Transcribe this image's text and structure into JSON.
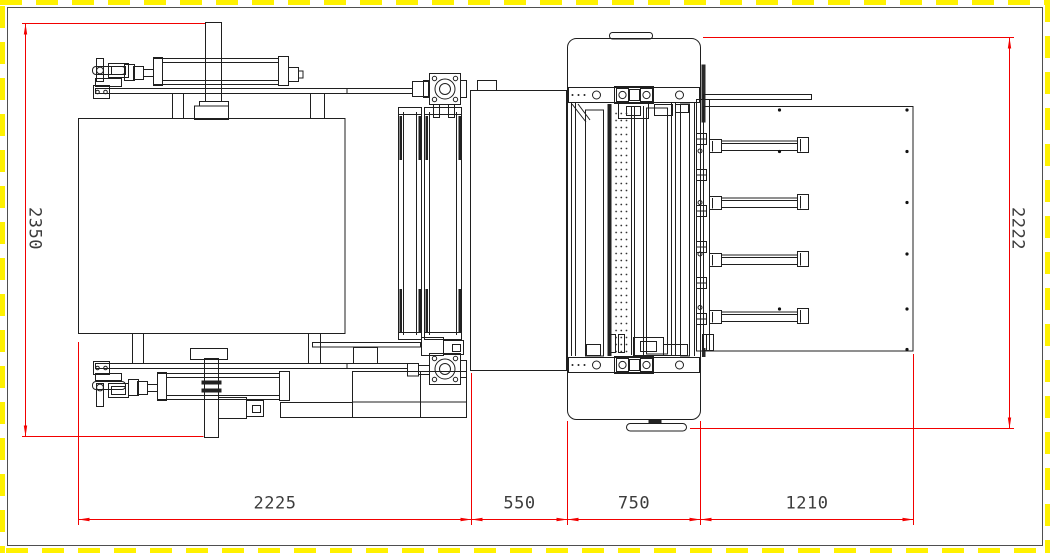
{
  "drawing": {
    "type": "engineering-drawing",
    "view": "machine-top-view",
    "colors": {
      "background": "#ffffff",
      "line": "#1f1f1f",
      "dimension_line": "#f20000",
      "dimension_text": "#3c3c3c",
      "border_dash": "#fff100"
    },
    "dimensions": {
      "left": {
        "label": "2350",
        "orientation": "vertical"
      },
      "right": {
        "label": "2222",
        "orientation": "vertical"
      },
      "bottom": [
        {
          "label": "2225"
        },
        {
          "label": "550"
        },
        {
          "label": "750"
        },
        {
          "label": "1210"
        }
      ]
    }
  }
}
